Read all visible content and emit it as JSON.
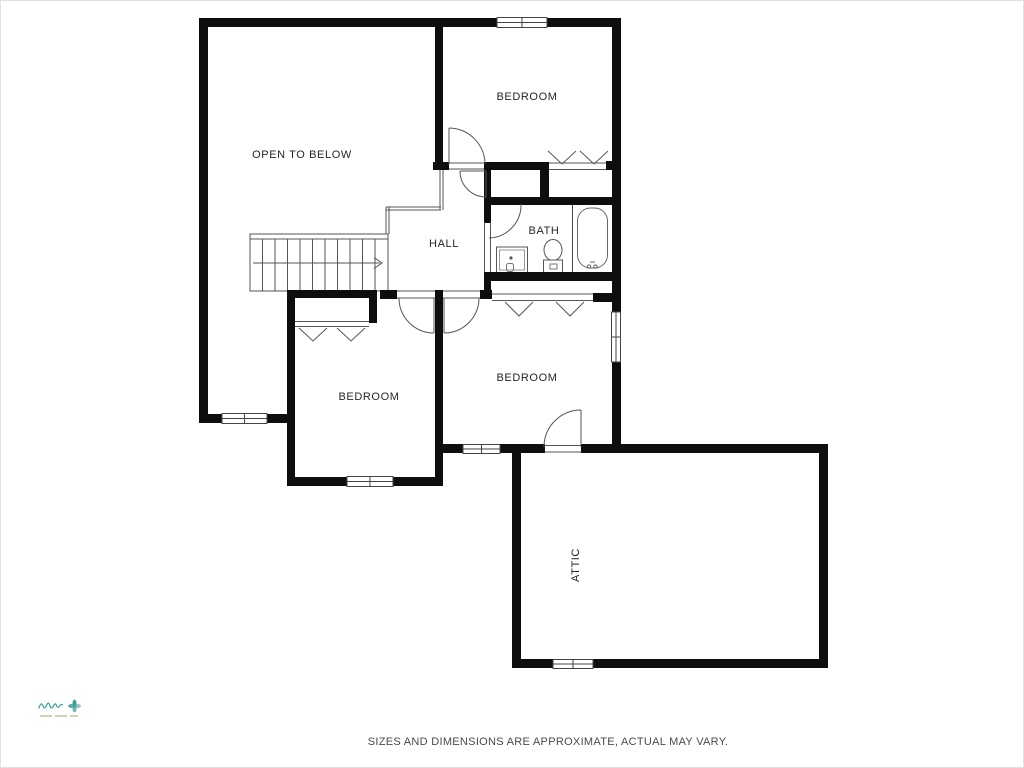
{
  "floorplan": {
    "rooms": [
      {
        "id": "open-to-below",
        "label": "OPEN TO BELOW"
      },
      {
        "id": "bedroom-upper",
        "label": "BEDROOM"
      },
      {
        "id": "hall",
        "label": "HALL"
      },
      {
        "id": "bath",
        "label": "BATH"
      },
      {
        "id": "bedroom-lower-left",
        "label": "BEDROOM"
      },
      {
        "id": "bedroom-lower-middle",
        "label": "BEDROOM"
      },
      {
        "id": "attic",
        "label": "ATTIC"
      }
    ],
    "fixtures": [
      {
        "name": "bathtub-icon"
      },
      {
        "name": "toilet-icon"
      },
      {
        "name": "sink-vanity-icon"
      },
      {
        "name": "staircase-icon"
      }
    ],
    "stairs": {
      "arrow_direction": "right",
      "treads": 11
    },
    "colors": {
      "wall": "#0e0e0e",
      "thin_line": "#555555",
      "fixture_line": "#666666",
      "label_text": "#262626",
      "background": "#ffffff"
    }
  },
  "footer": {
    "disclaimer": "SIZES AND DIMENSIONS ARE APPROXIMATE, ACTUAL MAY VARY."
  },
  "brand": {
    "icon": "pinwheel-flower-icon",
    "script_color": "#3d9e98",
    "tagline_color": "#c5ba90"
  }
}
